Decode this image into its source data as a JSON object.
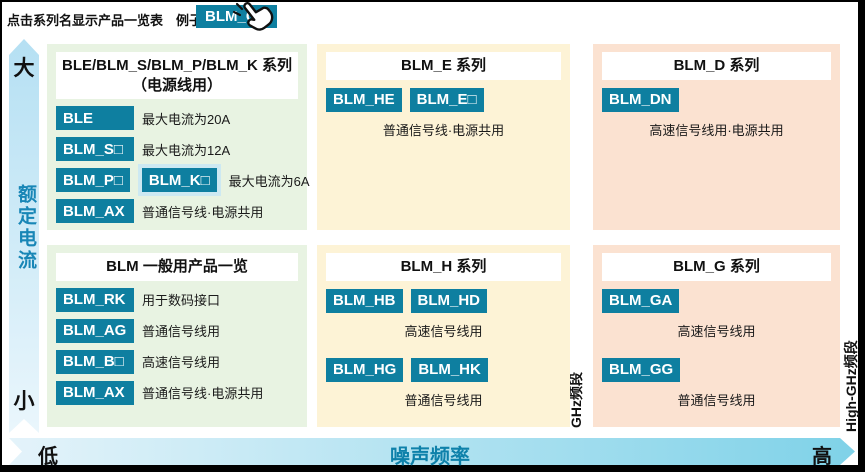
{
  "header": {
    "note": "点击系列名显示产品一览表　例子）",
    "example_button": "BLM_GA"
  },
  "colors": {
    "button_teal": "#0e7fa0",
    "panel_green": "#e8f3e2",
    "panel_yellow": "#fdf3d6",
    "panel_pink": "#fbe2d1",
    "halo_blue": "#cde9f2",
    "axis_text_blue": "#1886b6"
  },
  "axes": {
    "y": {
      "label": "额定电流",
      "top": "大",
      "bottom": "小"
    },
    "x": {
      "label": "噪声频率",
      "left": "低",
      "right": "高"
    },
    "bands": {
      "ghz": "GHz频段",
      "high_ghz": "High-GHz频段"
    }
  },
  "panels": [
    {
      "title_lines": [
        "BLE/BLM_S/BLM_P/BLM_K 系列",
        "（电源线用）"
      ],
      "layout": "inline",
      "rows": [
        {
          "buttons": [
            {
              "label": "BLE"
            }
          ],
          "desc": "最大电流为20A"
        },
        {
          "buttons": [
            {
              "label": "BLM_S□"
            }
          ],
          "desc": "最大电流为12A"
        },
        {
          "buttons": [
            {
              "label": "BLM_P□"
            },
            {
              "label": "BLM_K□",
              "halo": true
            }
          ],
          "desc": "最大电流为6A"
        },
        {
          "buttons": [
            {
              "label": "BLM_AX"
            }
          ],
          "desc": "普通信号线·电源共用"
        }
      ]
    },
    {
      "title_lines": [
        "BLM 一般用产品一览"
      ],
      "layout": "inline",
      "rows": [
        {
          "buttons": [
            {
              "label": "BLM_RK"
            }
          ],
          "desc": "用于数码接口"
        },
        {
          "buttons": [
            {
              "label": "BLM_AG"
            }
          ],
          "desc": "普通信号线用"
        },
        {
          "buttons": [
            {
              "label": "BLM_B□"
            }
          ],
          "desc": "高速信号线用"
        },
        {
          "buttons": [
            {
              "label": "BLM_AX"
            }
          ],
          "desc": "普通信号线·电源共用"
        }
      ]
    },
    {
      "title_lines": [
        "BLM_E 系列"
      ],
      "layout": "stacked",
      "rows": [
        {
          "buttons": [
            {
              "label": "BLM_HE"
            },
            {
              "label": "BLM_E□"
            }
          ],
          "desc": "普通信号线·电源共用"
        }
      ]
    },
    {
      "title_lines": [
        "BLM_H 系列"
      ],
      "layout": "stacked",
      "rows": [
        {
          "buttons": [
            {
              "label": "BLM_HB"
            },
            {
              "label": "BLM_HD"
            }
          ],
          "desc": "高速信号线用"
        },
        {
          "buttons": [
            {
              "label": "BLM_HG"
            },
            {
              "label": "BLM_HK"
            }
          ],
          "desc": "普通信号线用"
        }
      ]
    },
    {
      "title_lines": [
        "BLM_D 系列"
      ],
      "layout": "stacked",
      "rows": [
        {
          "buttons": [
            {
              "label": "BLM_DN"
            }
          ],
          "desc": "高速信号线用·电源共用"
        }
      ]
    },
    {
      "title_lines": [
        "BLM_G 系列"
      ],
      "layout": "stacked",
      "rows": [
        {
          "buttons": [
            {
              "label": "BLM_GA"
            }
          ],
          "desc": "高速信号线用"
        },
        {
          "buttons": [
            {
              "label": "BLM_GG"
            }
          ],
          "desc": "普通信号线用"
        }
      ]
    }
  ]
}
